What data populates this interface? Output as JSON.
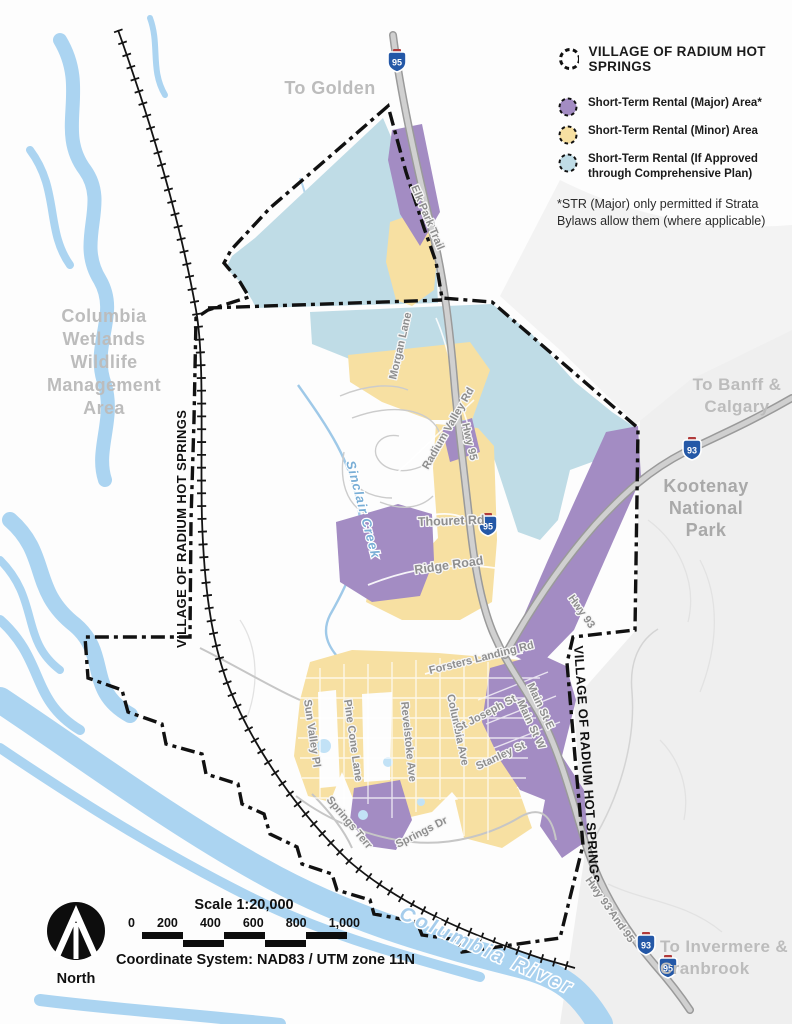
{
  "legend": {
    "title": "VILLAGE OF RADIUM HOT SPRINGS",
    "items": [
      {
        "label": "Short-Term Rental (Major) Area*",
        "color": "#a38cc3"
      },
      {
        "label": "Short-Term Rental (Minor) Area",
        "color": "#f7e0a2"
      },
      {
        "label": "Short-Term Rental (If Approved through Comprehensive Plan)",
        "color": "#bfdce6"
      }
    ],
    "footnote": "*STR (Major) only permitted if Strata Bylaws allow them (where applicable)"
  },
  "places": {
    "to_golden": "To Golden",
    "wetlands_lines": [
      "Columbia",
      "Wetlands",
      "Wildlife",
      "Management",
      "Area"
    ],
    "to_banff_lines": [
      "To Banff &",
      "Calgary"
    ],
    "kootenay_lines": [
      "Kootenay",
      "National",
      "Park"
    ],
    "to_invermere_lines": [
      "To Invermere &",
      "Cranbrook"
    ],
    "columbia_river": "Columbia River",
    "sinclair_creek": "Sinclair Creek",
    "village_boundary": "VILLAGE OF RADIUM HOT SPRINGS"
  },
  "roads": {
    "elk_park_trail": "Elk Park Trail",
    "morgan_lane": "Morgan Lane",
    "radium_valley_rd": "Radium Valley Rd",
    "hwy_95": "Hwy 95",
    "hwy_93": "Hwy 93",
    "thouret_rd": "Thouret Rd",
    "ridge_road": "Ridge Road",
    "forsters_landing_rd": "Forsters Landing Rd",
    "columbia_ave": "Columbia Ave",
    "sun_valley_pl": "Sun Valley Pl",
    "pine_cone_lane": "Pine Cone Lane",
    "revelstoke_ave": "Revelstoke Ave",
    "st_joseph_st": "St Joseph St",
    "stanley_st": "Stanley St",
    "main_st_e": "Main St E",
    "main_st_w": "Main St W",
    "springs_terr": "Springs Terr",
    "springs_dr": "Springs Dr",
    "hwy_93_and_95": "Hwy 93 And 95"
  },
  "shields": [
    {
      "number": "95"
    },
    {
      "number": "93"
    },
    {
      "number": "95"
    },
    {
      "number": "93"
    },
    {
      "number": "95"
    }
  ],
  "scalebar": {
    "title": "Scale 1:20,000",
    "ticks": [
      "0",
      "200",
      "400",
      "600",
      "800",
      "1,000"
    ],
    "coordinate_system": "Coordinate System: NAD83 / UTM zone 11N"
  },
  "north_label": "North",
  "colors": {
    "str_major": "#a38cc3",
    "str_minor": "#f7e0a2",
    "str_conditional": "#bfdce6",
    "water": "#abd4f1",
    "boundary": "#111111"
  }
}
